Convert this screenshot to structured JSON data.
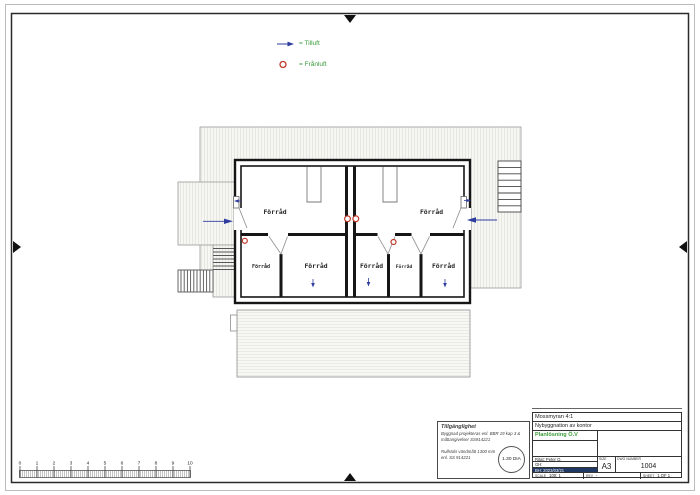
{
  "colors": {
    "supply_blue": "#2e3d9e",
    "exhaust_red": "#c0392b",
    "legend_green": "#3a9b3a",
    "wall_black": "#161616",
    "highlight_navy": "#1f3864"
  },
  "legend": {
    "tilluft_label": "= Tilluft",
    "franluft_label": "= Frånluft"
  },
  "plan": {
    "rooms": [
      "Förråd",
      "Förråd",
      "Förråd",
      "Förråd",
      "Förråd",
      "Förråd",
      "Förråd"
    ]
  },
  "accessibility_note": {
    "title": "Tillgänglighet",
    "lines": [
      "Byggnad projekteras enl. BBR 19 kap 3 &",
      "måttangivelser SS914221",
      "Rullstols vändmått 1300 mm",
      "enl. SS 914221"
    ],
    "turning_circle_label": "1.30 DIA"
  },
  "title_block": {
    "project": "Mossmyran 4:1",
    "description": "Nybyggnation av kontor",
    "drawing_title": "Planlösning Ö.V",
    "drawn_by": "Ritat: Peter O.",
    "checked": "GH:",
    "approved_date": "BH: 2023/03/21",
    "size_label": "SIZE",
    "size_value": "A3",
    "dwg_label": "DWG NUMBER",
    "dwg_value": "1004",
    "scale_label": "SCALE",
    "scale_value": "100: 1",
    "rev_label": "REV",
    "rev_value": "-",
    "sheet_label": "SHEET",
    "sheet_value": "1 OF 1"
  },
  "ruler": {
    "ticks": [
      "0",
      "1",
      "2",
      "3",
      "4",
      "5",
      "6",
      "7",
      "8",
      "9",
      "10"
    ]
  }
}
